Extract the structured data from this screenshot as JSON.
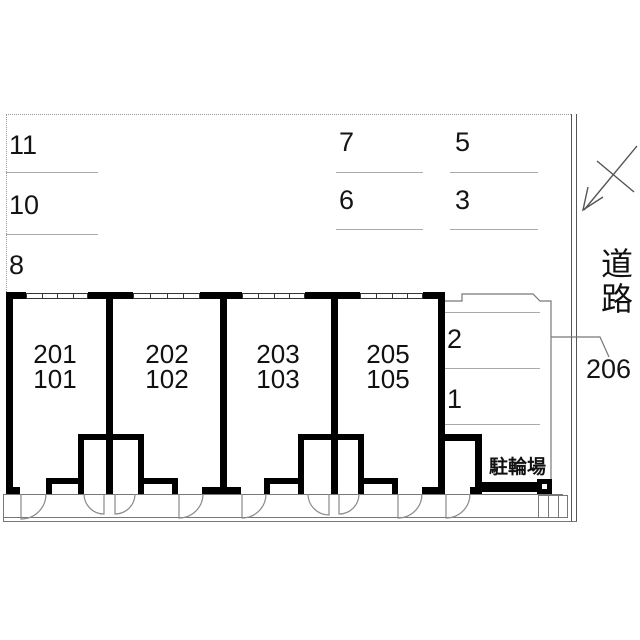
{
  "site_plan": {
    "units": [
      {
        "upper": "201",
        "lower": "101"
      },
      {
        "upper": "202",
        "lower": "102"
      },
      {
        "upper": "203",
        "lower": "103"
      },
      {
        "upper": "205",
        "lower": "105"
      }
    ],
    "parking": {
      "left_column": [
        {
          "label": "11"
        },
        {
          "label": "10"
        },
        {
          "label": "8"
        }
      ],
      "middle_column_a": [
        {
          "label": "7"
        },
        {
          "label": "6"
        }
      ],
      "middle_column_b": [
        {
          "label": "5"
        },
        {
          "label": "3"
        }
      ],
      "right_column": [
        {
          "label": "2"
        },
        {
          "label": "1"
        }
      ]
    },
    "labels": {
      "bicycle_parking": "駐輪場",
      "road": "道路",
      "unit_206": "206"
    },
    "colors": {
      "wall": "#000000",
      "thin_line": "#777777",
      "parking_divider": "#aaaaaa",
      "text": "#111111",
      "background": "#ffffff"
    }
  }
}
